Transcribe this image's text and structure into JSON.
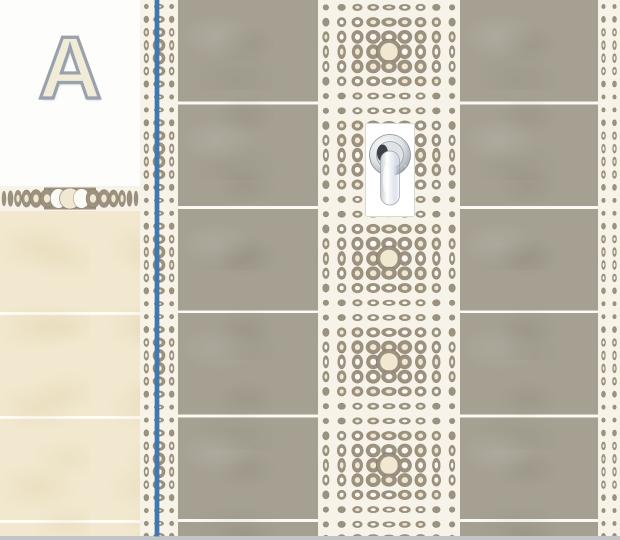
{
  "elevation": {
    "label": "A"
  },
  "fixture": {
    "name": "shower-mixer"
  },
  "palette": {
    "wall_white": "#fdfdfb",
    "tile_beige": "#f1e8cf",
    "tile_gray": "#a5a092",
    "grout_white": "#faf9f3",
    "pattern_taupe": "#9d9280",
    "pattern_taupe_dark": "#746b59",
    "pattern_cream": "#f0e8d1",
    "pattern_white": "#fbfaf4",
    "pattern_bg": "#f7f3e8",
    "marker_blue": "#3e79b4",
    "floor_gray": "#c2c6c9",
    "label_fill": "#f1ecd8",
    "label_outline": "#99a2ac"
  }
}
